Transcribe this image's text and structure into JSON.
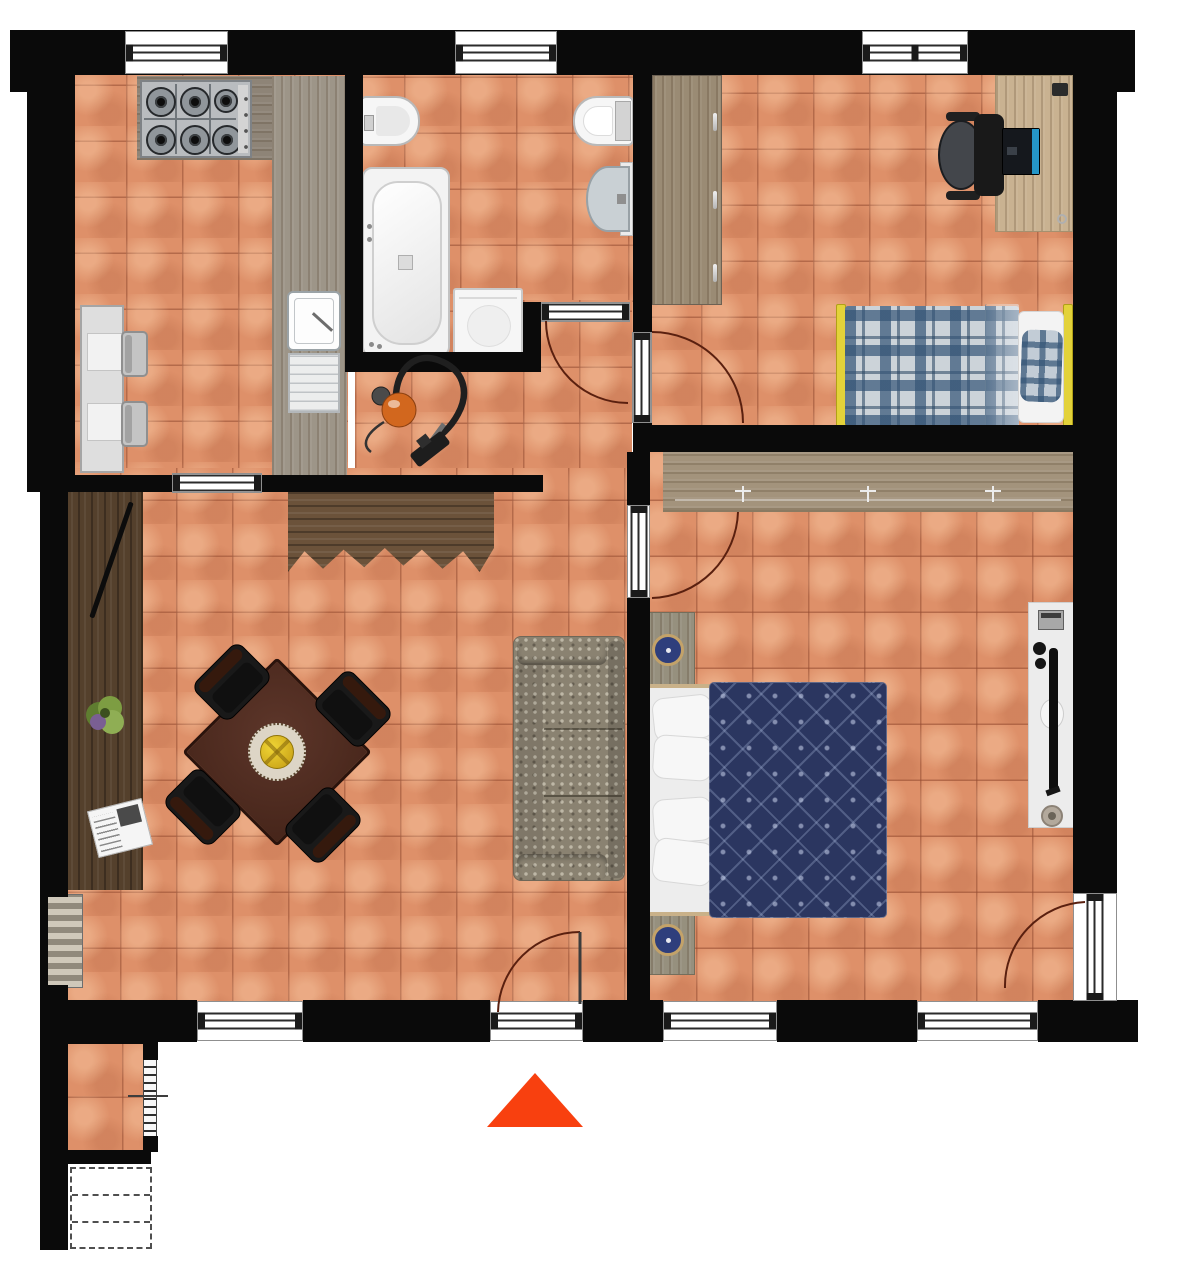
{
  "meta": {
    "type": "apartment-floor-plan",
    "canvas": {
      "width": 1184,
      "height": 1280
    },
    "view": "top-down"
  },
  "palette": {
    "background": "#ffffff",
    "wall": "#0a0a0a",
    "tile": "#de9069",
    "grout": "#92442f",
    "door_arc": "#5a200f",
    "entrance_arrow": "#f8400f",
    "counter": "#9d9588",
    "dark_wood": "#54402c",
    "light_wood": "#c9b291",
    "bed_frame_yellow": "#e3d23a",
    "plaid_blue": "#345476",
    "duvet_navy": "#2b3660",
    "sofa_taupe": "#8a8271",
    "fixture_white": "#f6f6f6",
    "vacuum_orange": "#d2671e"
  },
  "rooms": [
    {
      "id": "kitchen",
      "position": "top-left"
    },
    {
      "id": "bathroom",
      "position": "top-center"
    },
    {
      "id": "bedroom",
      "position": "top-right"
    },
    {
      "id": "hallway",
      "position": "center"
    },
    {
      "id": "living-dining-room",
      "position": "bottom-left"
    },
    {
      "id": "master-bedroom",
      "position": "bottom-right"
    },
    {
      "id": "balcony-stair-landing",
      "position": "bottom-left-outside"
    }
  ],
  "furniture": [
    {
      "room": "kitchen",
      "items": [
        "gas-hob-6-burners",
        "l-shaped-counter",
        "sink-with-drainer",
        "small-table",
        "two-chairs"
      ]
    },
    {
      "room": "bathroom",
      "items": [
        "bathtub",
        "bidet",
        "toilet",
        "washbasin",
        "washing-machine"
      ]
    },
    {
      "room": "hallway",
      "items": [
        "vacuum-cleaner"
      ]
    },
    {
      "room": "bedroom",
      "items": [
        "wardrobe",
        "desk",
        "office-chair",
        "laptop",
        "single-bed-yellow-frame-plaid-blanket"
      ]
    },
    {
      "room": "living-dining-room",
      "items": [
        "wall-sideboard",
        "long-side-cabinet",
        "plant",
        "newspaper",
        "square-dining-table",
        "four-chairs",
        "fruit-bowl",
        "sofa"
      ]
    },
    {
      "room": "master-bedroom",
      "items": [
        "closet-rail-with-hangers",
        "double-bed",
        "two-nightstands",
        "decorative-plates",
        "tv-console",
        "tv",
        "speaker"
      ]
    },
    {
      "room": "balcony-stair-landing",
      "items": [
        "steps",
        "staircase-dashed"
      ]
    }
  ],
  "geometry": {
    "floors": [
      {
        "name": "floor-kitchen",
        "x": 70,
        "y": 70,
        "w": 278,
        "h": 408
      },
      {
        "name": "floor-bathroom",
        "x": 348,
        "y": 70,
        "w": 290,
        "h": 288
      },
      {
        "name": "floor-hallway",
        "x": 355,
        "y": 300,
        "w": 277,
        "h": 180
      },
      {
        "name": "floor-bedroom",
        "x": 645,
        "y": 70,
        "w": 432,
        "h": 360
      },
      {
        "name": "floor-living",
        "x": 64,
        "y": 468,
        "w": 567,
        "h": 537
      },
      {
        "name": "floor-master",
        "x": 640,
        "y": 445,
        "w": 436,
        "h": 560
      },
      {
        "name": "floor-balcony",
        "x": 66,
        "y": 1040,
        "w": 80,
        "h": 114
      }
    ],
    "walls": [
      {
        "name": "wall-top",
        "x": 10,
        "y": 30,
        "w": 1123,
        "h": 45
      },
      {
        "name": "wall-top-left-pillar",
        "x": 10,
        "y": 30,
        "w": 63,
        "h": 62
      },
      {
        "name": "wall-top-right-pillar",
        "x": 1073,
        "y": 30,
        "w": 62,
        "h": 62
      },
      {
        "name": "wall-left-kitchen",
        "x": 27,
        "y": 70,
        "w": 48,
        "h": 422
      },
      {
        "name": "wall-left-living",
        "x": 40,
        "y": 477,
        "w": 28,
        "h": 420
      },
      {
        "name": "wall-left-living-thin",
        "x": 40,
        "y": 894,
        "w": 8,
        "h": 94
      },
      {
        "name": "wall-left-lower",
        "x": 40,
        "y": 985,
        "w": 28,
        "h": 58
      },
      {
        "name": "wall-balcony-left",
        "x": 40,
        "y": 1020,
        "w": 28,
        "h": 230
      },
      {
        "name": "wall-balcony-top",
        "x": 40,
        "y": 1020,
        "w": 106,
        "h": 24
      },
      {
        "name": "wall-balcony-bottom",
        "x": 66,
        "y": 1150,
        "w": 85,
        "h": 14
      },
      {
        "name": "wall-balcony-right-upper",
        "x": 143,
        "y": 1040,
        "w": 15,
        "h": 20
      },
      {
        "name": "wall-balcony-right-lower",
        "x": 143,
        "y": 1136,
        "w": 15,
        "h": 16
      },
      {
        "name": "wall-south-a",
        "x": 40,
        "y": 1000,
        "w": 157,
        "h": 42
      },
      {
        "name": "wall-south-b",
        "x": 303,
        "y": 1000,
        "w": 187,
        "h": 42
      },
      {
        "name": "wall-south-c",
        "x": 583,
        "y": 1000,
        "w": 80,
        "h": 42
      },
      {
        "name": "wall-south-d",
        "x": 777,
        "y": 1000,
        "w": 140,
        "h": 42
      },
      {
        "name": "wall-south-e",
        "x": 1038,
        "y": 1000,
        "w": 100,
        "h": 42
      },
      {
        "name": "wall-right",
        "x": 1073,
        "y": 70,
        "w": 44,
        "h": 823
      },
      {
        "name": "wall-kitchen-bath",
        "x": 345,
        "y": 70,
        "w": 18,
        "h": 297
      },
      {
        "name": "wall-bath-south",
        "x": 345,
        "y": 352,
        "w": 196,
        "h": 20
      },
      {
        "name": "wall-bath-stub",
        "x": 523,
        "y": 302,
        "w": 18,
        "h": 70
      },
      {
        "name": "wall-bath-bedroom",
        "x": 633,
        "y": 70,
        "w": 19,
        "h": 262
      },
      {
        "name": "wall-bedroom-stub",
        "x": 633,
        "y": 423,
        "w": 19,
        "h": 29
      },
      {
        "name": "wall-bedrooms-divider",
        "x": 633,
        "y": 425,
        "w": 440,
        "h": 27
      },
      {
        "name": "wall-living-master-upper",
        "x": 627,
        "y": 452,
        "w": 23,
        "h": 55
      },
      {
        "name": "wall-living-master-lower",
        "x": 627,
        "y": 598,
        "w": 23,
        "h": 404
      },
      {
        "name": "wall-kitchen-south",
        "x": 68,
        "y": 475,
        "w": 104,
        "h": 17
      },
      {
        "name": "wall-hall-south",
        "x": 262,
        "y": 475,
        "w": 281,
        "h": 17
      }
    ],
    "windows": [
      {
        "name": "window-kitchen",
        "x": 125,
        "y": 31,
        "w": 103,
        "h": 43,
        "orient": "h"
      },
      {
        "name": "window-bathroom",
        "x": 455,
        "y": 31,
        "w": 102,
        "h": 43,
        "orient": "h"
      },
      {
        "name": "window-bedroom",
        "x": 862,
        "y": 31,
        "w": 106,
        "h": 43,
        "orient": "h",
        "mullion": true
      },
      {
        "name": "window-living-south",
        "x": 197,
        "y": 1001,
        "w": 106,
        "h": 40,
        "orient": "h"
      },
      {
        "name": "window-master-south-left",
        "x": 663,
        "y": 1001,
        "w": 114,
        "h": 40,
        "orient": "h"
      },
      {
        "name": "window-master-south-right",
        "x": 917,
        "y": 1001,
        "w": 121,
        "h": 40,
        "orient": "h"
      }
    ],
    "doors": [
      {
        "name": "door-bathroom",
        "x": 541,
        "y": 302,
        "w": 89,
        "h": 20,
        "orient": "h"
      },
      {
        "name": "door-bedroom",
        "x": 632,
        "y": 332,
        "w": 20,
        "h": 91,
        "orient": "v"
      },
      {
        "name": "door-master-bedroom",
        "x": 627,
        "y": 505,
        "w": 23,
        "h": 93,
        "orient": "v"
      },
      {
        "name": "door-entrance",
        "x": 490,
        "y": 1001,
        "w": 93,
        "h": 40,
        "orient": "h"
      },
      {
        "name": "door-master-balcony",
        "x": 1073,
        "y": 893,
        "w": 44,
        "h": 108,
        "orient": "v"
      }
    ],
    "openings": [
      {
        "name": "opening-kitchen-living",
        "x": 172,
        "y": 473,
        "w": 90,
        "h": 20,
        "orient": "h"
      }
    ],
    "arcs": {
      "bathroom": "M 546 321 A 82 82 0 0 0 628 403",
      "bedroom": "M 652 332 A 91 91 0 0 1 743 423",
      "master": "M 738 512 A 89 89 0 0 1 652 598",
      "entrance": "M 580 932 A 82 82 0 0 0 498 1012",
      "balcony": "M 1085 902 A 84 84 0 0 0 1005 988"
    },
    "markers": {
      "entrance_arrow": {
        "x": 487,
        "y": 1073,
        "w": 96,
        "h": 54,
        "color": "#f8400f",
        "direction": "up"
      }
    }
  }
}
